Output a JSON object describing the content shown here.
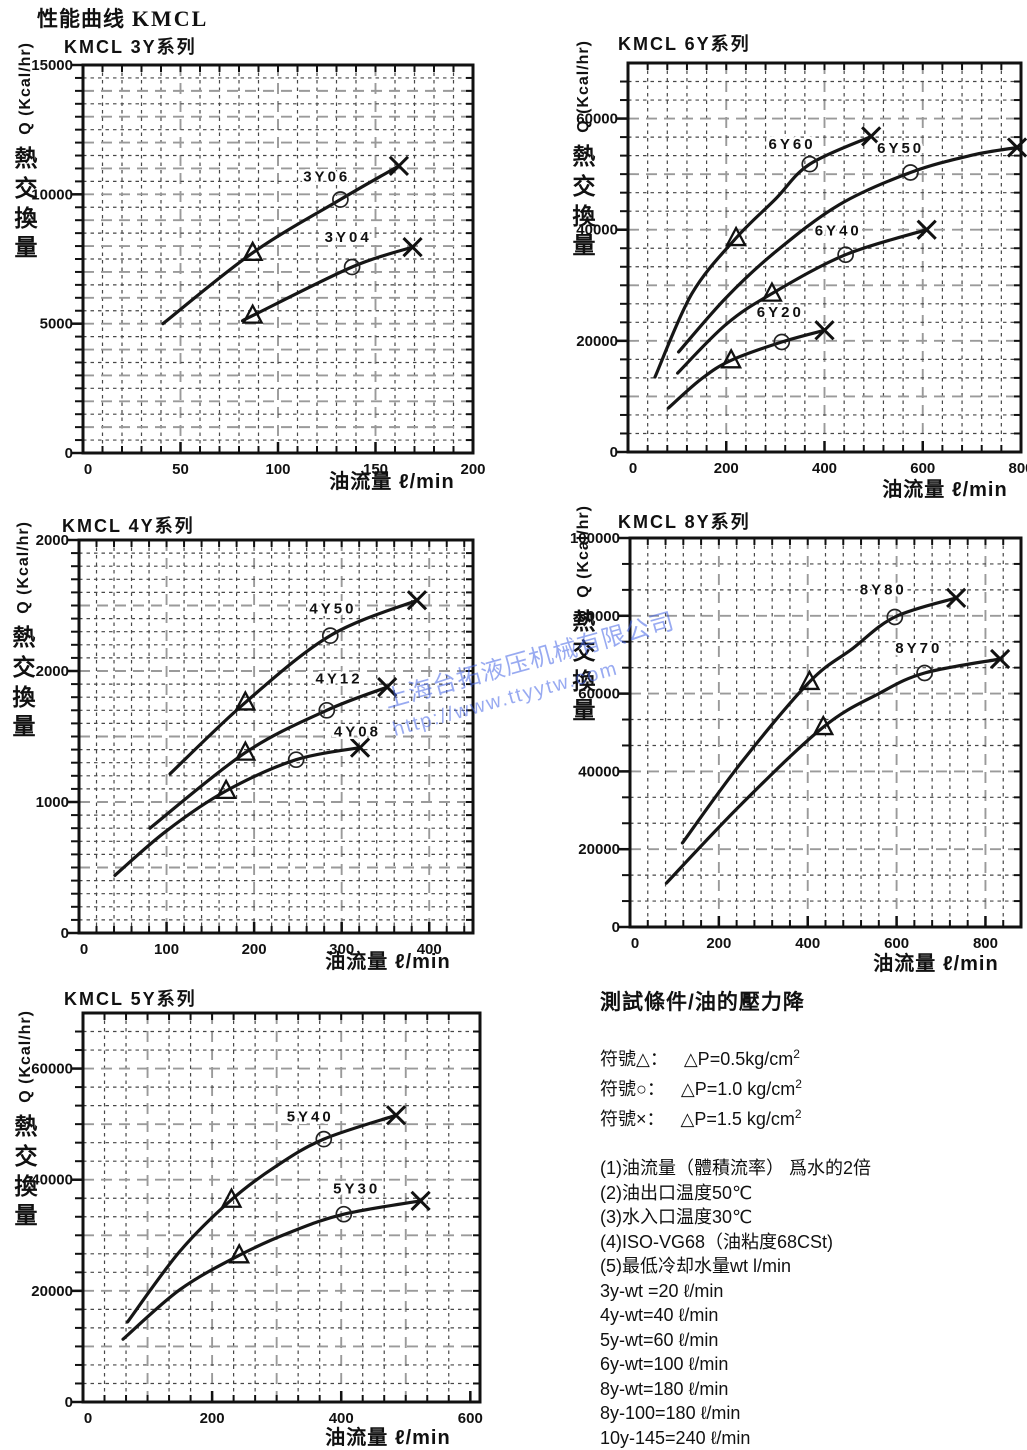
{
  "page": {
    "title_cjk": "性能曲线",
    "title_latin": "KMCL"
  },
  "watermark": {
    "line1": "上海台拓液压机械有限公司",
    "line2": "http://www.ttyytw.com",
    "color": "#4565e6"
  },
  "chart_data": [
    {
      "type": "line",
      "title": "KMCL 3Y系列",
      "x_axis": {
        "title": "油流量 ℓ/min",
        "max": 200,
        "fine": 10,
        "medium": 50,
        "ticks": [
          [
            0,
            "0"
          ],
          [
            50,
            "50"
          ],
          [
            100,
            "100"
          ],
          [
            150,
            "150"
          ],
          [
            200,
            "200"
          ]
        ]
      },
      "y_axis": {
        "label_cjk": "熱交換量",
        "label_latin": "Q (Kcal/hr)",
        "max": 15000,
        "fine": 500,
        "medium": 1000,
        "ticks": [
          [
            0,
            "0"
          ],
          [
            5000,
            "5000"
          ],
          [
            10000,
            "10000"
          ],
          [
            15000,
            "15000"
          ]
        ]
      },
      "series": [
        {
          "name": "3Y06",
          "label_at": [
            125,
            10500
          ],
          "points": [
            [
              41,
              5000
            ],
            [
              87,
              7740
            ],
            [
              132,
              9800
            ],
            [
              162,
              11100
            ]
          ],
          "markers": [
            [
              "tri",
              87,
              7740
            ],
            [
              "circ",
              132,
              9800
            ],
            [
              "x",
              162,
              11100
            ]
          ]
        },
        {
          "name": "3Y04",
          "label_at": [
            136,
            8150
          ],
          "points": [
            [
              83,
              5150
            ],
            [
              87,
              5310
            ],
            [
              138,
              7190
            ],
            [
              169,
              7960
            ]
          ],
          "markers": [
            [
              "tri",
              87,
              5310
            ],
            [
              "circ",
              138,
              7190
            ],
            [
              "x",
              169,
              7960
            ]
          ]
        }
      ]
    },
    {
      "type": "line",
      "title": "KMCL 6Y系列",
      "x_axis": {
        "title": "油流量 ℓ/min",
        "max": 800,
        "fine": 40,
        "medium": 200,
        "ticks": [
          [
            0,
            "0"
          ],
          [
            200,
            "200"
          ],
          [
            400,
            "400"
          ],
          [
            600,
            "600"
          ],
          [
            800,
            "800"
          ]
        ]
      },
      "y_axis": {
        "label_cjk": "熱交換量",
        "label_latin": "Q (Kcal/hr)",
        "max": 70000,
        "fine": 3333.33,
        "medium": 10000,
        "ticks": [
          [
            0,
            "0"
          ],
          [
            20000,
            "20000"
          ],
          [
            40000,
            "40000"
          ],
          [
            60000,
            "60000"
          ]
        ]
      },
      "series": [
        {
          "name": "6Y60",
          "label_at": [
            334,
            54500
          ],
          "points": [
            [
              55,
              13500
            ],
            [
              130,
              28500
            ],
            [
              220,
              38500
            ],
            [
              300,
              45500
            ],
            [
              370,
              51800
            ],
            [
              495,
              56800
            ]
          ],
          "markers": [
            [
              "tri",
              220,
              38500
            ],
            [
              "circ",
              370,
              51800
            ],
            [
              "x",
              495,
              56800
            ]
          ]
        },
        {
          "name": "6Y50",
          "label_at": [
            555,
            53800
          ],
          "points": [
            [
              103,
              18000
            ],
            [
              200,
              27800
            ],
            [
              300,
              36000
            ],
            [
              430,
              44500
            ],
            [
              575,
              50300
            ],
            [
              700,
              53400
            ],
            [
              792,
              54800
            ]
          ],
          "markers": [
            [
              "circ",
              575,
              50300
            ],
            [
              "x",
              792,
              54800
            ]
          ]
        },
        {
          "name": "6Y40",
          "label_at": [
            428,
            39000
          ],
          "points": [
            [
              101,
              14200
            ],
            [
              200,
              23000
            ],
            [
              293,
              28500
            ],
            [
              443,
              35500
            ],
            [
              608,
              40000
            ]
          ],
          "markers": [
            [
              "tri",
              293,
              28500
            ],
            [
              "circ",
              443,
              35500
            ],
            [
              "x",
              608,
              40000
            ]
          ]
        },
        {
          "name": "6Y20",
          "label_at": [
            310,
            24300
          ],
          "points": [
            [
              82,
              7900
            ],
            [
              150,
              13200
            ],
            [
              210,
              16500
            ],
            [
              313,
              19800
            ],
            [
              400,
              21900
            ]
          ],
          "markers": [
            [
              "tri",
              210,
              16500
            ],
            [
              "circ",
              313,
              19800
            ],
            [
              "x",
              400,
              21900
            ]
          ]
        }
      ]
    },
    {
      "type": "line",
      "title": "KMCL 4Y系列",
      "x_axis": {
        "title": "油流量 ℓ/min",
        "max": 450,
        "fine": 20,
        "medium": 100,
        "ticks": [
          [
            0,
            "0"
          ],
          [
            100,
            "100"
          ],
          [
            200,
            "200"
          ],
          [
            300,
            "300"
          ],
          [
            400,
            "400"
          ]
        ]
      },
      "y_axis": {
        "label_cjk": "熱交換量",
        "label_latin": "Q (Kcal/hr)",
        "max": 3000,
        "fine": 100,
        "medium": 500,
        "ticks": [
          [
            0,
            "0"
          ],
          [
            1000,
            "1000"
          ],
          [
            2000,
            "2000"
          ],
          [
            3000,
            "2000"
          ]
        ]
      },
      "series": [
        {
          "name": "4Y50",
          "label_at": [
            290,
            2440
          ],
          "points": [
            [
              104,
              1215
            ],
            [
              190,
              1760
            ],
            [
              287,
              2270
            ],
            [
              386,
              2540
            ]
          ],
          "markers": [
            [
              "tri",
              190,
              1760
            ],
            [
              "circ",
              287,
              2270
            ],
            [
              "x",
              386,
              2540
            ]
          ]
        },
        {
          "name": "4Y12",
          "label_at": [
            297,
            1905
          ],
          "points": [
            [
              81,
              800
            ],
            [
              190,
              1377
            ],
            [
              283,
              1700
            ],
            [
              352,
              1877
            ]
          ],
          "markers": [
            [
              "tri",
              190,
              1377
            ],
            [
              "circ",
              283,
              1700
            ],
            [
              "x",
              352,
              1877
            ]
          ]
        },
        {
          "name": "4Y08",
          "label_at": [
            318,
            1500
          ],
          "points": [
            [
              41,
              440
            ],
            [
              100,
              780
            ],
            [
              168,
              1085
            ],
            [
              248,
              1323
            ],
            [
              321,
              1415
            ]
          ],
          "markers": [
            [
              "tri",
              168,
              1085
            ],
            [
              "circ",
              248,
              1323
            ],
            [
              "x",
              321,
              1415
            ]
          ]
        }
      ]
    },
    {
      "type": "line",
      "title": "KMCL 8Y系列",
      "x_axis": {
        "title": "油流量 ℓ/min",
        "max": 880,
        "fine": 40,
        "medium": 200,
        "ticks": [
          [
            0,
            "0"
          ],
          [
            200,
            "200"
          ],
          [
            400,
            "400"
          ],
          [
            600,
            "600"
          ],
          [
            800,
            "800"
          ]
        ]
      },
      "y_axis": {
        "label_cjk": "熱交換量",
        "label_latin": "Q (Kcal/hr)",
        "max": 100000,
        "fine": 6666.67,
        "medium": 20000,
        "ticks": [
          [
            0,
            "0"
          ],
          [
            20000,
            "20000"
          ],
          [
            40000,
            "40000"
          ],
          [
            60000,
            "60000"
          ],
          [
            80000,
            "80000"
          ],
          [
            100000,
            "100000"
          ]
        ]
      },
      "series": [
        {
          "name": "8Y80",
          "label_at": [
            570,
            85500
          ],
          "points": [
            [
              118,
              21600
            ],
            [
              250,
              42200
            ],
            [
              404,
              63000
            ],
            [
              500,
              71500
            ],
            [
              596,
              79700
            ],
            [
              734,
              84600
            ]
          ],
          "markers": [
            [
              "tri",
              404,
              63000
            ],
            [
              "circ",
              596,
              79700
            ],
            [
              "x",
              734,
              84600
            ]
          ]
        },
        {
          "name": "8Y70",
          "label_at": [
            650,
            70500
          ],
          "points": [
            [
              82,
              11300
            ],
            [
              250,
              31500
            ],
            [
              435,
              51400
            ],
            [
              560,
              60000
            ],
            [
              663,
              65300
            ],
            [
              833,
              68900
            ]
          ],
          "markers": [
            [
              "tri",
              435,
              51400
            ],
            [
              "circ",
              663,
              65300
            ],
            [
              "x",
              833,
              68900
            ]
          ]
        }
      ]
    },
    {
      "type": "line",
      "title": "KMCL 5Y系列",
      "x_axis": {
        "title": "油流量 ℓ/min",
        "max": 615,
        "fine": 33.33,
        "medium": 100,
        "ticks": [
          [
            0,
            "0"
          ],
          [
            200,
            "200"
          ],
          [
            400,
            "400"
          ],
          [
            600,
            "600"
          ]
        ]
      },
      "y_axis": {
        "label_cjk": "熱交換量",
        "label_latin": "Q (Kcal/hr)",
        "max": 70000,
        "fine": 3333.33,
        "medium": 10000,
        "ticks": [
          [
            0,
            "0"
          ],
          [
            20000,
            "20000"
          ],
          [
            40000,
            "40000"
          ],
          [
            60000,
            "60000"
          ]
        ]
      },
      "series": [
        {
          "name": "5Y40",
          "label_at": [
            352,
            50500
          ],
          "points": [
            [
              69,
              14400
            ],
            [
              150,
              27100
            ],
            [
              230,
              36400
            ],
            [
              300,
              42500
            ],
            [
              373,
              47300
            ],
            [
              485,
              51600
            ]
          ],
          "markers": [
            [
              "tri",
              230,
              36400
            ],
            [
              "circ",
              373,
              47300
            ],
            [
              "x",
              485,
              51600
            ]
          ]
        },
        {
          "name": "5Y30",
          "label_at": [
            424,
            37500
          ],
          "points": [
            [
              62,
              11300
            ],
            [
              150,
              20200
            ],
            [
              242,
              26400
            ],
            [
              320,
              30500
            ],
            [
              404,
              33800
            ],
            [
              523,
              36200
            ]
          ],
          "markers": [
            [
              "tri",
              242,
              26400
            ],
            [
              "circ",
              404,
              33800
            ],
            [
              "x",
              523,
              36200
            ]
          ]
        }
      ]
    }
  ],
  "test_conditions": {
    "title": "測試條件/油的壓力降",
    "symbols": [
      {
        "pre": "符號△：",
        "base": "△P=0.5kg/cm",
        "sup": "2"
      },
      {
        "pre": "符號○：",
        "base": "△P=1.0 kg/cm",
        "sup": "2"
      },
      {
        "pre": "符號×：",
        "base": "△P=1.5 kg/cm",
        "sup": "2"
      }
    ],
    "notes": [
      "(1)油流量（體積流率） 爲水的2倍",
      "(2)油出口温度50℃",
      "(3)水入口温度30℃",
      "(4)ISO-VG68（油粘度68CSt)",
      "(5)最低冷却水量wt l/min",
      "3y-wt =20  ℓ/min",
      "4y-wt=40  ℓ/min",
      "5y-wt=60  ℓ/min",
      "6y-wt=100  ℓ/min",
      "8y-wt=180  ℓ/min",
      "8y-100=180  ℓ/min",
      "10y-145=240  ℓ/min"
    ]
  }
}
